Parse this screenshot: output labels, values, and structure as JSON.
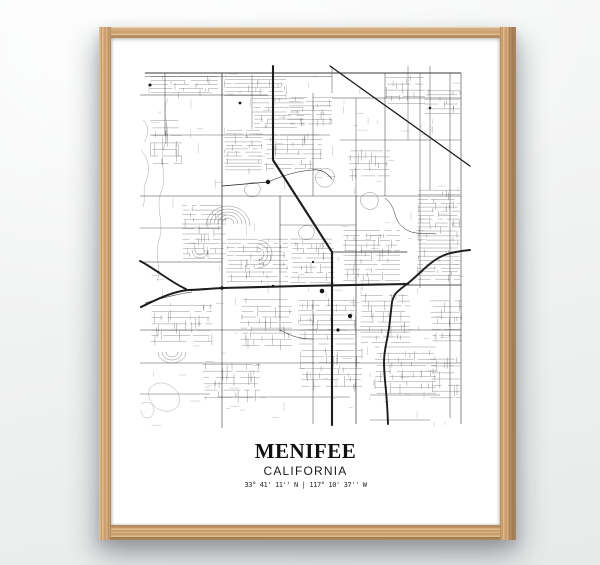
{
  "poster": {
    "title": "MENIFEE",
    "subtitle": "CALIFORNIA",
    "coordinates": "33° 41' 11'' N | 117° 10' 37'' W"
  },
  "colors": {
    "wall": "#f0f1f1",
    "frame_wood": "#cda273",
    "poster_background": "#ffffff",
    "map_ink": "#2b2b2b"
  }
}
